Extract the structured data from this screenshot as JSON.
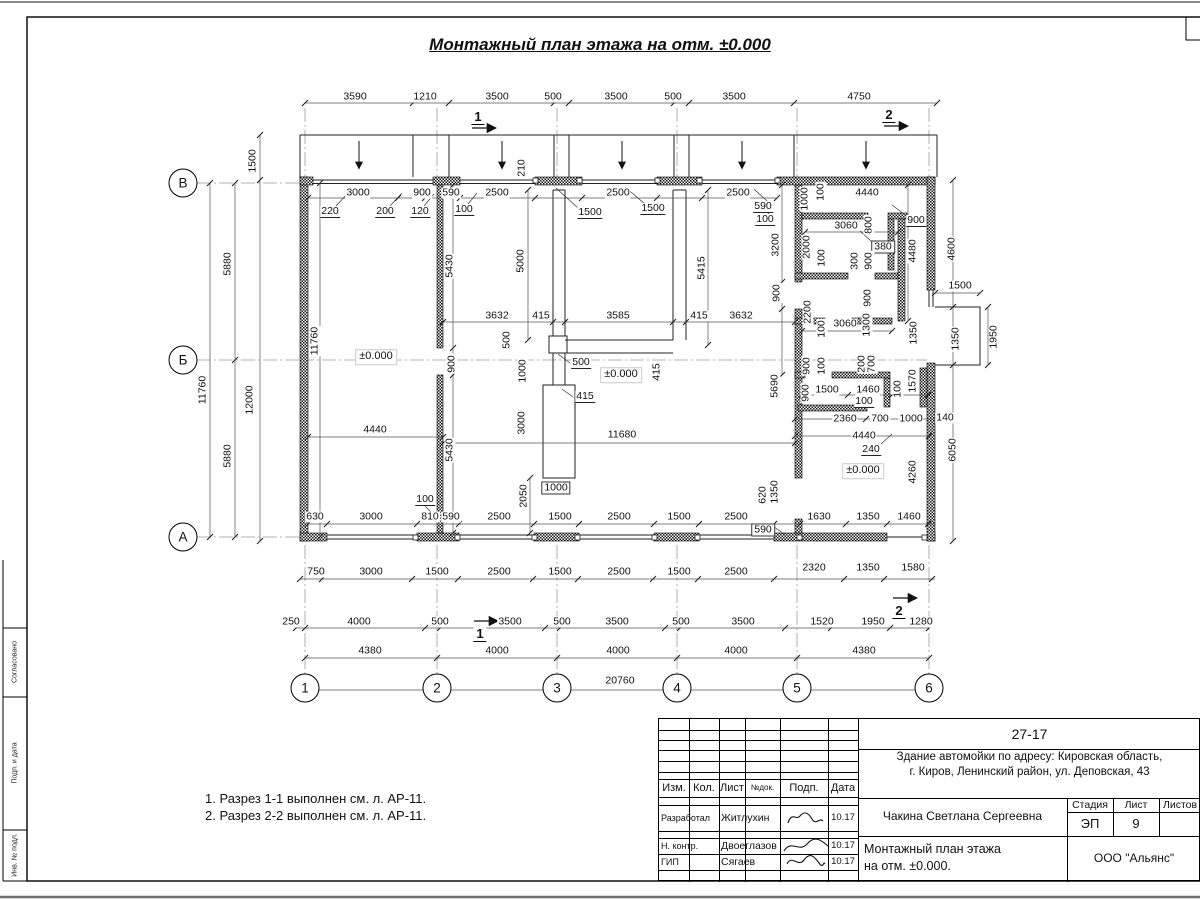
{
  "sheet_title": "Монтажный план этажа на отм. ±0.000",
  "notes": {
    "lines": [
      "1. Разрез 1-1 выполнен см. л. АР-11.",
      "2. Разрез 2-2 выполнен см. л. АР-11."
    ]
  },
  "margin_labels": [
    {
      "t": "Согласовано",
      "y": 662
    },
    {
      "t": "Подп. и дата",
      "y": 763
    },
    {
      "t": "Инв. № подл.",
      "y": 855
    }
  ],
  "plan": {
    "axes": [
      {
        "label": "В",
        "x": 183,
        "y": 183
      },
      {
        "label": "Б",
        "x": 183,
        "y": 360
      },
      {
        "label": "А",
        "x": 183,
        "y": 537
      },
      {
        "label": "1",
        "x": 305,
        "y": 688
      },
      {
        "label": "2",
        "x": 437,
        "y": 688
      },
      {
        "label": "3",
        "x": 557,
        "y": 688
      },
      {
        "label": "4",
        "x": 677,
        "y": 688
      },
      {
        "label": "5",
        "x": 797,
        "y": 688
      },
      {
        "label": "6",
        "x": 929,
        "y": 688
      }
    ],
    "dims": [
      {
        "t": "3590",
        "x": 355,
        "y": 97
      },
      {
        "t": "1210",
        "x": 425,
        "y": 97
      },
      {
        "t": "3500",
        "x": 497,
        "y": 97
      },
      {
        "t": "500",
        "x": 553,
        "y": 97
      },
      {
        "t": "3500",
        "x": 616,
        "y": 97
      },
      {
        "t": "500",
        "x": 673,
        "y": 97
      },
      {
        "t": "3500",
        "x": 734,
        "y": 97
      },
      {
        "t": "4750",
        "x": 859,
        "y": 97
      },
      {
        "t": "1500",
        "x": 253,
        "y": 161,
        "v": 1
      },
      {
        "t": "210",
        "x": 522,
        "y": 168,
        "v": 1
      },
      {
        "t": "3000",
        "x": 358,
        "y": 193
      },
      {
        "t": "900",
        "x": 422,
        "y": 193
      },
      {
        "t": "590",
        "x": 451,
        "y": 193
      },
      {
        "t": "2500",
        "x": 497,
        "y": 193
      },
      {
        "t": "2500",
        "x": 618,
        "y": 193
      },
      {
        "t": "2500",
        "x": 738,
        "y": 193
      },
      {
        "t": "220",
        "x": 330,
        "y": 212,
        "c": "u"
      },
      {
        "t": "200",
        "x": 385,
        "y": 212,
        "c": "u"
      },
      {
        "t": "120",
        "x": 420,
        "y": 212,
        "c": "u"
      },
      {
        "t": "100",
        "x": 464,
        "y": 210,
        "c": "u"
      },
      {
        "t": "1500",
        "x": 590,
        "y": 213,
        "c": "u"
      },
      {
        "t": "1500",
        "x": 653,
        "y": 209,
        "c": "u"
      },
      {
        "t": "590",
        "x": 763,
        "y": 207,
        "c": "u"
      },
      {
        "t": "100",
        "x": 765,
        "y": 220,
        "c": "u"
      },
      {
        "t": "4440",
        "x": 867,
        "y": 193
      },
      {
        "t": "1000",
        "x": 805,
        "y": 199,
        "v": 1
      },
      {
        "t": "100",
        "x": 821,
        "y": 192,
        "v": 1
      },
      {
        "t": "900",
        "x": 916,
        "y": 221,
        "c": "u"
      },
      {
        "t": "3060",
        "x": 846,
        "y": 226
      },
      {
        "t": "800",
        "x": 869,
        "y": 225,
        "v": 1
      },
      {
        "t": "380",
        "x": 883,
        "y": 247,
        "c": "b"
      },
      {
        "t": "2000",
        "x": 807,
        "y": 247,
        "v": 1
      },
      {
        "t": "300",
        "x": 855,
        "y": 261,
        "v": 1
      },
      {
        "t": "900",
        "x": 869,
        "y": 261,
        "v": 1
      },
      {
        "t": "100",
        "x": 822,
        "y": 258,
        "v": 1
      },
      {
        "t": "4480",
        "x": 913,
        "y": 251,
        "v": 1
      },
      {
        "t": "4600",
        "x": 952,
        "y": 249,
        "v": 1
      },
      {
        "t": "3200",
        "x": 776,
        "y": 245,
        "v": 1
      },
      {
        "t": "900",
        "x": 777,
        "y": 293,
        "v": 1
      },
      {
        "t": "2200",
        "x": 808,
        "y": 312,
        "v": 1
      },
      {
        "t": "900",
        "x": 868,
        "y": 298,
        "v": 1
      },
      {
        "t": "3060",
        "x": 845,
        "y": 324
      },
      {
        "t": "100",
        "x": 822,
        "y": 329,
        "v": 1
      },
      {
        "t": "1300",
        "x": 867,
        "y": 325,
        "v": 1
      },
      {
        "t": "1350",
        "x": 914,
        "y": 333,
        "v": 1
      },
      {
        "t": "1500",
        "x": 960,
        "y": 286
      },
      {
        "t": "1350",
        "x": 956,
        "y": 339,
        "v": 1
      },
      {
        "t": "1950",
        "x": 994,
        "y": 337,
        "v": 1
      },
      {
        "t": "900",
        "x": 807,
        "y": 366,
        "v": 1
      },
      {
        "t": "100",
        "x": 822,
        "y": 366,
        "v": 1
      },
      {
        "t": "200",
        "x": 862,
        "y": 364,
        "v": 1
      },
      {
        "t": "700",
        "x": 872,
        "y": 364,
        "v": 1
      },
      {
        "t": "1570",
        "x": 913,
        "y": 381,
        "v": 1
      },
      {
        "t": "100",
        "x": 898,
        "y": 389,
        "v": 1
      },
      {
        "t": "5690",
        "x": 775,
        "y": 386,
        "v": 1
      },
      {
        "t": "1500",
        "x": 827,
        "y": 390
      },
      {
        "t": "1460",
        "x": 868,
        "y": 390
      },
      {
        "t": "100",
        "x": 864,
        "y": 402,
        "c": "u"
      },
      {
        "t": "900",
        "x": 806,
        "y": 393,
        "v": 1
      },
      {
        "t": "2360",
        "x": 845,
        "y": 419
      },
      {
        "t": "700",
        "x": 880,
        "y": 419
      },
      {
        "t": "1000",
        "x": 911,
        "y": 419
      },
      {
        "t": "140",
        "x": 945,
        "y": 418
      },
      {
        "t": "4440",
        "x": 864,
        "y": 436
      },
      {
        "t": "240",
        "x": 871,
        "y": 450,
        "c": "u"
      },
      {
        "t": "4260",
        "x": 913,
        "y": 472,
        "v": 1
      },
      {
        "t": "6050",
        "x": 953,
        "y": 450,
        "v": 1
      },
      {
        "t": "1350",
        "x": 775,
        "y": 492,
        "v": 1
      },
      {
        "t": "620",
        "x": 763,
        "y": 495,
        "v": 1
      },
      {
        "t": "590",
        "x": 763,
        "y": 530,
        "c": "b"
      },
      {
        "t": "1630",
        "x": 819,
        "y": 517
      },
      {
        "t": "1350",
        "x": 868,
        "y": 517
      },
      {
        "t": "1460",
        "x": 909,
        "y": 517
      },
      {
        "t": "2320",
        "x": 814,
        "y": 568
      },
      {
        "t": "1350",
        "x": 868,
        "y": 568
      },
      {
        "t": "1580",
        "x": 913,
        "y": 568
      },
      {
        "t": "5430",
        "x": 450,
        "y": 266,
        "v": 1
      },
      {
        "t": "5430",
        "x": 450,
        "y": 450,
        "v": 1
      },
      {
        "t": "5000",
        "x": 521,
        "y": 261,
        "v": 1
      },
      {
        "t": "5415",
        "x": 702,
        "y": 268,
        "v": 1
      },
      {
        "t": "11760",
        "x": 315,
        "y": 341,
        "v": 1
      },
      {
        "t": "12000",
        "x": 250,
        "y": 400,
        "v": 1
      },
      {
        "t": "11760",
        "x": 203,
        "y": 390,
        "v": 1
      },
      {
        "t": "5880",
        "x": 228,
        "y": 264,
        "v": 1
      },
      {
        "t": "5880",
        "x": 228,
        "y": 456,
        "v": 1
      },
      {
        "t": "3632",
        "x": 497,
        "y": 316
      },
      {
        "t": "415",
        "x": 541,
        "y": 316
      },
      {
        "t": "3585",
        "x": 618,
        "y": 316
      },
      {
        "t": "415",
        "x": 699,
        "y": 316
      },
      {
        "t": "3632",
        "x": 741,
        "y": 316
      },
      {
        "t": "500",
        "x": 507,
        "y": 340,
        "v": 1
      },
      {
        "t": "900",
        "x": 452,
        "y": 364,
        "v": 1
      },
      {
        "t": "1000",
        "x": 523,
        "y": 371,
        "v": 1
      },
      {
        "t": "500",
        "x": 581,
        "y": 363,
        "c": "u"
      },
      {
        "t": "415",
        "x": 585,
        "y": 397,
        "c": "u"
      },
      {
        "t": "415",
        "x": 657,
        "y": 372,
        "v": 1
      },
      {
        "t": "3000",
        "x": 522,
        "y": 423,
        "v": 1
      },
      {
        "t": "2050",
        "x": 524,
        "y": 496,
        "v": 1
      },
      {
        "t": "1000",
        "x": 556,
        "y": 488,
        "c": "b"
      },
      {
        "t": "100",
        "x": 425,
        "y": 500,
        "c": "u"
      },
      {
        "t": "4440",
        "x": 375,
        "y": 430
      },
      {
        "t": "11680",
        "x": 622,
        "y": 435
      },
      {
        "t": "±0.000",
        "x": 376,
        "y": 357,
        "c": "lvl"
      },
      {
        "t": "±0.000",
        "x": 621,
        "y": 375,
        "c": "lvl"
      },
      {
        "t": "±0.000",
        "x": 863,
        "y": 471,
        "c": "lvl"
      },
      {
        "t": "630",
        "x": 315,
        "y": 517
      },
      {
        "t": "3000",
        "x": 371,
        "y": 517
      },
      {
        "t": "810",
        "x": 430,
        "y": 517
      },
      {
        "t": "590",
        "x": 451,
        "y": 517
      },
      {
        "t": "2500",
        "x": 499,
        "y": 517
      },
      {
        "t": "1500",
        "x": 560,
        "y": 517
      },
      {
        "t": "2500",
        "x": 619,
        "y": 517
      },
      {
        "t": "1500",
        "x": 679,
        "y": 517
      },
      {
        "t": "2500",
        "x": 736,
        "y": 517
      },
      {
        "t": "750",
        "x": 316,
        "y": 572
      },
      {
        "t": "3000",
        "x": 371,
        "y": 572
      },
      {
        "t": "1500",
        "x": 437,
        "y": 572
      },
      {
        "t": "2500",
        "x": 499,
        "y": 572
      },
      {
        "t": "1500",
        "x": 560,
        "y": 572
      },
      {
        "t": "2500",
        "x": 619,
        "y": 572
      },
      {
        "t": "1500",
        "x": 679,
        "y": 572
      },
      {
        "t": "2500",
        "x": 736,
        "y": 572
      },
      {
        "t": "250",
        "x": 291,
        "y": 622
      },
      {
        "t": "4000",
        "x": 359,
        "y": 622
      },
      {
        "t": "500",
        "x": 440,
        "y": 622
      },
      {
        "t": "3500",
        "x": 510,
        "y": 622
      },
      {
        "t": "500",
        "x": 562,
        "y": 622
      },
      {
        "t": "3500",
        "x": 617,
        "y": 622
      },
      {
        "t": "500",
        "x": 681,
        "y": 622
      },
      {
        "t": "3500",
        "x": 743,
        "y": 622
      },
      {
        "t": "1520",
        "x": 822,
        "y": 622
      },
      {
        "t": "1950",
        "x": 873,
        "y": 622
      },
      {
        "t": "1280",
        "x": 921,
        "y": 622
      },
      {
        "t": "4380",
        "x": 370,
        "y": 651
      },
      {
        "t": "4000",
        "x": 497,
        "y": 651
      },
      {
        "t": "4000",
        "x": 618,
        "y": 651
      },
      {
        "t": "4000",
        "x": 736,
        "y": 651
      },
      {
        "t": "4380",
        "x": 864,
        "y": 651
      },
      {
        "t": "20760",
        "x": 620,
        "y": 681
      },
      {
        "t": "1",
        "x": 478,
        "y": 117,
        "c": "sec"
      },
      {
        "t": "2",
        "x": 889,
        "y": 115,
        "c": "sec"
      },
      {
        "t": "1",
        "x": 480,
        "y": 634,
        "c": "sec"
      },
      {
        "t": "2",
        "x": 899,
        "y": 611,
        "c": "sec"
      }
    ]
  },
  "titleblock": {
    "code": "27-17",
    "address1": "Здание автомойки по адресу: Кировская область,",
    "address2": "г. Киров, Ленинский район, ул. Деповская, 43",
    "person": "Чакина Светлана Сергеевна",
    "doc_title1": "Монтажный план этажа",
    "doc_title2": "на отм. ±0.000.",
    "company": "ООО \"Альянс\"",
    "stage_label": "Стадия",
    "sheet_label": "Лист",
    "sheets_label": "Листов",
    "stage": "ЭП",
    "sheet": "9",
    "cols": [
      "Изм.",
      "Кол.",
      "Лист",
      "№док.",
      "Подп.",
      "Дата"
    ],
    "rows": [
      {
        "role": "Разработал",
        "name": "Житлухин",
        "date": "10.17"
      },
      {
        "role": "Н. контр.",
        "name": "Двоеглазов",
        "date": "10.17"
      },
      {
        "role": "ГИП",
        "name": "Сягаев",
        "date": "10.17"
      }
    ]
  }
}
